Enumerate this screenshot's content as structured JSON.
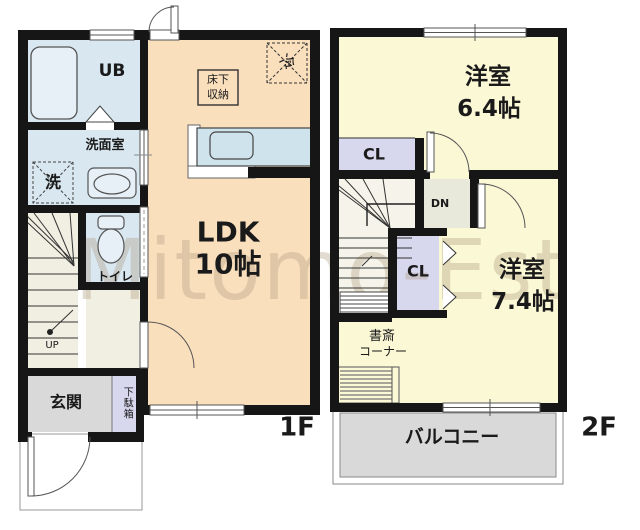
{
  "watermark": "Mitomo-Est",
  "floor1": {
    "floor_label": "1F",
    "ub_label": "UB",
    "senmenshitsu_label": "洗面室",
    "washer_label": "洗",
    "toilet_label": "トイレ",
    "ldk_name": "LDK",
    "ldk_size": "10帖",
    "yukashita_line1": "床下",
    "yukashita_line2": "収納",
    "fridge_label": "冷",
    "genkan_label": "玄関",
    "getabako_label": "下駄箱",
    "up_label": "UP"
  },
  "floor2": {
    "floor_label": "2F",
    "room1_name": "洋室",
    "room1_size": "6.4帖",
    "cl_upper_label": "CL",
    "dn_label": "DN",
    "cl_lower_label": "CL",
    "room2_name": "洋室",
    "room2_size": "7.4帖",
    "shosai_line1": "書斎",
    "shosai_line2": "コーナー",
    "balcony_label": "バルコニー"
  },
  "colors": {
    "wall": "#161616",
    "ldk_fill": "#fadfbd",
    "wet_room_fill": "#d8e7f0",
    "bedroom_fill": "#fbf8d6",
    "closet_fill": "#d7d7ee",
    "entrance_fill": "#d9d9d9",
    "hall_fill": "#f1efe2",
    "counter_fill": "#cfe3ed",
    "watermark_color": "rgba(172,152,122,0.35)"
  }
}
